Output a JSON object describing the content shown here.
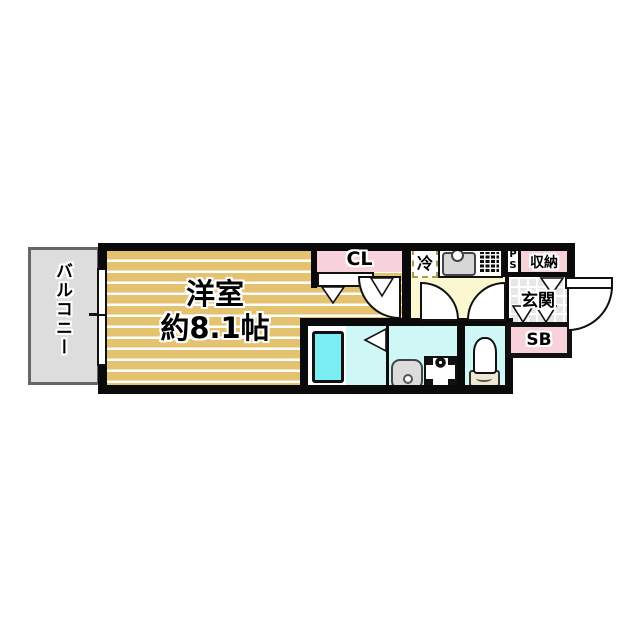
{
  "plan_type": "apartment-floor-plan",
  "labels": {
    "balcony": "バルコニー",
    "room_name": "洋室",
    "room_size": "約8.1帖",
    "closet": "CL",
    "refrigerator": "冷",
    "pipe_space_p": "P",
    "pipe_space_s": "S",
    "storage": "収納",
    "entrance": "玄関",
    "shoe_box": "SB"
  },
  "colors": {
    "wall": "#0A0A0A",
    "flooring_tan": "#E4C26F",
    "closet_pink": "#F8D2DA",
    "kitchen_yellow": "#FBF7D0",
    "wet_area_cyan": "#CFF7F5",
    "bathtub_cyan": "#7AEDF2",
    "balcony_gray": "#DDDDDD",
    "entrance_tile_gray": "#E7E7E7"
  },
  "fixtures": [
    "bathtub-icon",
    "washbasin-icon",
    "washing-machine-pan-icon",
    "toilet-icon",
    "kitchen-sink-icon",
    "gas-stove-icon",
    "refrigerator-space",
    "door-swing-symbols",
    "window-symbol"
  ]
}
